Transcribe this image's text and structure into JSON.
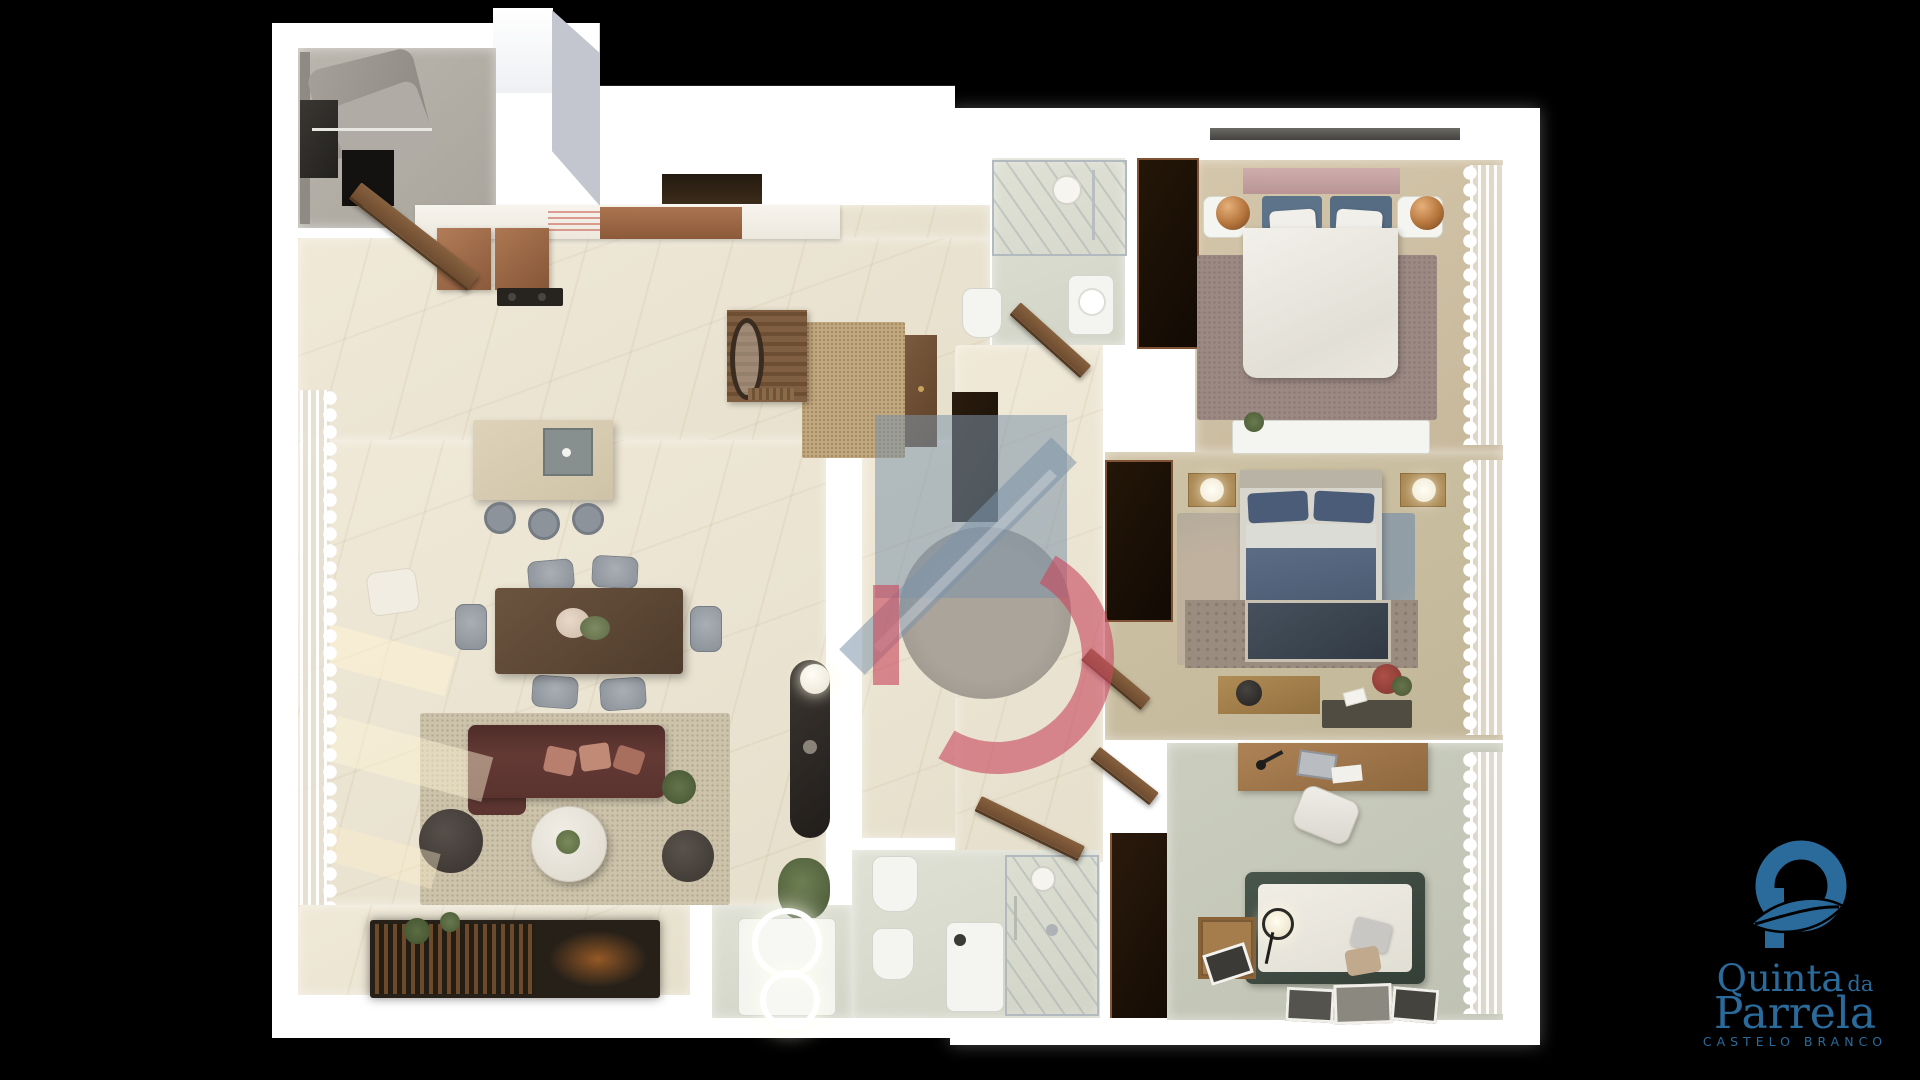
{
  "branding": {
    "logo": {
      "mark_icon": "q-leaf-monogram-icon",
      "name_line1": "Quinta",
      "name_connector": "da",
      "name_line2": "Parrela",
      "subtitle": "CASTELO BRANCO"
    }
  },
  "watermark": {
    "icon": "house-d-monogram-icon",
    "shape": "translucent roof band and square with red letter D over hallway"
  },
  "scene": {
    "type": "3d-floor-plan-top-down-render",
    "background": "#000000",
    "rooms": [
      {
        "name": "laundry-storage",
        "position": "top-left",
        "furniture": [
          "wall-shelving",
          "hanging-garments",
          "dark-appliance"
        ]
      },
      {
        "name": "kitchen",
        "furniture": [
          "white-counter",
          "copper-cabinets",
          "cooktop",
          "island-with-sink",
          "three-bar-stools"
        ]
      },
      {
        "name": "dining-area",
        "furniture": [
          "dark-wood-table",
          "six-grey-chairs",
          "flower-centerpiece",
          "cream-lounge-chair"
        ]
      },
      {
        "name": "living-room",
        "furniture": [
          "burgundy-sofa",
          "salmon-cushions",
          "round-marble-coffee-table",
          "two-dark-poufs",
          "beige-area-rug",
          "slatted-media-console-with-fireplace",
          "plants",
          "sheer-curtains",
          "black-console-with-sphere-lamp"
        ]
      },
      {
        "name": "entry-hall",
        "furniture": [
          "jute-rug",
          "coat-rack-with-mirror",
          "bench",
          "tall-wood-cabinet",
          "open-front-door"
        ]
      },
      {
        "name": "hallway",
        "furniture": [
          "round-grey-rug",
          "dark-recess"
        ]
      },
      {
        "name": "bathroom-ensuite",
        "furniture": [
          "walk-in-shower",
          "toilet",
          "washbasin",
          "open-door"
        ]
      },
      {
        "name": "master-bedroom",
        "furniture": [
          "double-bed-white-duvet",
          "pink-headboard",
          "blue-throw",
          "two-copper-sphere-lamps",
          "white-nightstands",
          "dark-wardrobe",
          "mauve-rug",
          "white-dresser-with-plant",
          "sheer-curtains"
        ]
      },
      {
        "name": "bedroom-2",
        "furniture": [
          "double-bed-blue-duvet",
          "blue-pillows",
          "oak-nightstands-with-glowing-lamps",
          "dark-wardrobe",
          "patchwork-rug",
          "oak-tv-console",
          "wall-tv-on-stone-panel",
          "flower-vase",
          "sheer-curtains"
        ]
      },
      {
        "name": "bedroom-3",
        "furniture": [
          "oak-desk",
          "laptop",
          "white-office-chair",
          "green-frame-daybed",
          "glowing-floor-lamp",
          "crate-side-table",
          "leaning-picture-frames",
          "sheer-curtains"
        ]
      },
      {
        "name": "bathroom-2",
        "furniture": [
          "glass-shower",
          "toilet",
          "bidet",
          "vanity",
          "two-backlit-round-mirrors",
          "open-door"
        ]
      }
    ]
  },
  "colors": {
    "brand_blue": "#2a6b9c",
    "wm_blue": "rgba(126,147,168,0.55)",
    "wm_red": "rgba(201,75,96,0.62)",
    "wall_white": "#ffffff",
    "marble_cream": "#ece5d4",
    "copper_cabinet": "#9d6b4b",
    "sofa_burgundy": "#5c3531",
    "bed_blue": "#54657c",
    "oak_wood": "#a8854f",
    "sage_floor": "#c7cabb",
    "mauve_rug": "#9c8983"
  }
}
